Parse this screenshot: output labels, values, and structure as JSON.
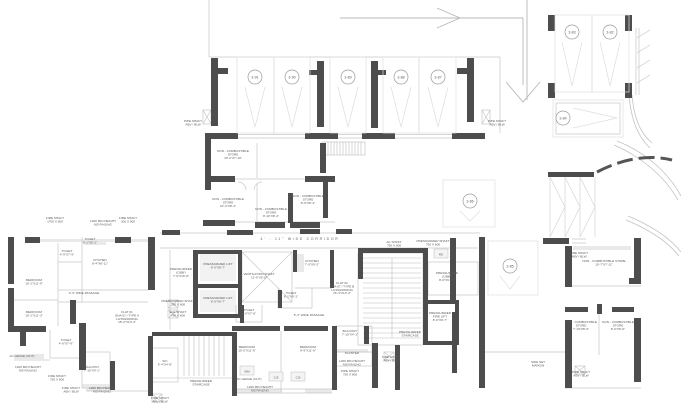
{
  "palette": {
    "wall": "#4d4d4d",
    "line_light": "#c7c7c7",
    "line_faint": "#dedede",
    "fill_light": "#e9e9e9",
    "text": "#5a5a5a",
    "tag_stroke": "#9a9a9a"
  },
  "parking_stalls": [
    {
      "id": "3-91",
      "cx": 255,
      "cy": 77,
      "rect": [
        237,
        57,
        37,
        76
      ],
      "dir": "down"
    },
    {
      "id": "3-90",
      "cx": 292,
      "cy": 77,
      "rect": [
        274,
        57,
        36,
        76
      ],
      "dir": "down"
    },
    {
      "id": "3-89",
      "cx": 348,
      "cy": 77,
      "rect": [
        330,
        57,
        36,
        76
      ],
      "dir": "down"
    },
    {
      "id": "3-88",
      "cx": 401,
      "cy": 77,
      "rect": [
        383,
        57,
        36,
        76
      ],
      "dir": "down"
    },
    {
      "id": "3-87",
      "cx": 438,
      "cy": 77,
      "rect": [
        419,
        57,
        37,
        76
      ],
      "dir": "down"
    },
    {
      "id": "3-83",
      "cx": 572,
      "cy": 32,
      "rect": [
        555,
        15,
        37,
        77
      ],
      "dir": "down"
    },
    {
      "id": "3-82",
      "cx": 610,
      "cy": 32,
      "rect": [
        592,
        15,
        37,
        77
      ],
      "dir": "down"
    },
    {
      "id": "3-84",
      "cx": 563,
      "cy": 118,
      "rect": [
        553,
        100,
        70,
        37
      ],
      "dir": "right"
    },
    {
      "id": "3-86",
      "cx": 470,
      "cy": 201,
      "rect": [
        443,
        180,
        52,
        47
      ],
      "dir": "down"
    },
    {
      "id": "3-85",
      "cx": 510,
      "cy": 266,
      "rect": [
        488,
        241,
        50,
        54
      ],
      "dir": "down"
    }
  ],
  "annotations": [
    {
      "name": "corridor-note",
      "x": 300,
      "y": 240,
      "size": 3.4,
      "spacing": 1.8,
      "lines": [
        "4' - 11\" WIDE CORRIDOR"
      ]
    },
    {
      "name": "pipe-shaft-note",
      "x": 193,
      "y": 122,
      "lines": [
        "PIPE SHAFT",
        "ABV / BLW"
      ]
    },
    {
      "name": "pipe-shaft-note",
      "x": 497,
      "y": 122,
      "lines": [
        "PIPE SHAFT",
        "ABV / BLW"
      ]
    },
    {
      "name": "store-label",
      "x": 233,
      "y": 152,
      "lines": [
        "NON - COMBUSTIBLE",
        "STORE",
        "10'-2\"X7'-10\""
      ]
    },
    {
      "name": "store-label",
      "x": 228,
      "y": 200,
      "lines": [
        "NON - COMBUSTIBLE",
        "STORE",
        "10'-3\"X8'-4\""
      ]
    },
    {
      "name": "store-label",
      "x": 271,
      "y": 210,
      "lines": [
        "NON - COMBUSTIBLE",
        "STORE",
        "8'-10\"X8'-4\""
      ]
    },
    {
      "name": "store-label",
      "x": 308,
      "y": 197,
      "lines": [
        "NON - COMBUSTIBLE",
        "STORE",
        "8'-9\"X8'-4\""
      ]
    },
    {
      "name": "shaft-note",
      "x": 55,
      "y": 219,
      "lines": [
        "FIRE SHAFT",
        "1700 X 600"
      ]
    },
    {
      "name": "railing-note",
      "x": 103,
      "y": 222,
      "lines": [
        "1200 MIN HEIGHT",
        "MS RAILING"
      ]
    },
    {
      "name": "shaft-note",
      "x": 128,
      "y": 219,
      "lines": [
        "FIRE SHAFT",
        "200 X 600"
      ]
    },
    {
      "name": "room-label",
      "x": 34,
      "y": 281,
      "lines": [
        "BEDROOM",
        "10'-2\"X11'-9\""
      ]
    },
    {
      "name": "room-label",
      "x": 34,
      "y": 313,
      "lines": [
        "BEDROOM",
        "10'-2\"X11'-3\""
      ]
    },
    {
      "name": "room-label",
      "x": 67,
      "y": 252,
      "lines": [
        "TOILET",
        "4'-9\"X7'-9\""
      ]
    },
    {
      "name": "room-label",
      "x": 90,
      "y": 240,
      "lines": [
        "TOILET",
        "8'-1\"X5'-1\""
      ]
    },
    {
      "name": "room-label",
      "x": 100,
      "y": 261,
      "lines": [
        "KITCHEN",
        "8'-4\"X8'-11\""
      ]
    },
    {
      "name": "passage-note",
      "x": 84,
      "y": 294,
      "lines": [
        "3'-3\" WIDE PASSAGE"
      ]
    },
    {
      "name": "flat-title",
      "x": 127,
      "y": 313,
      "lines": [
        "FLAT 01",
        "GHA 07 / TYPE A",
        "LIVING/DINING",
        "18'-0\"X13'-3\""
      ]
    },
    {
      "name": "room-label",
      "x": 66,
      "y": 341,
      "lines": [
        "TOILET",
        "4'-9\"X7'-9\""
      ]
    },
    {
      "name": "ledge-note",
      "x": 22,
      "y": 357,
      "lines": [
        "AC LEDGE (OUT)"
      ]
    },
    {
      "name": "railing-note",
      "x": 28,
      "y": 368,
      "lines": [
        "1200 MIN HEIGHT",
        "MS RAILING"
      ]
    },
    {
      "name": "room-label",
      "x": 92,
      "y": 368,
      "lines": [
        "BALCONY",
        "7'-10\"X4'-1\""
      ]
    },
    {
      "name": "shaft-note",
      "x": 57,
      "y": 377,
      "lines": [
        "FIRE SHAFT",
        "750 X 600"
      ]
    },
    {
      "name": "shaft-note",
      "x": 71,
      "y": 389,
      "lines": [
        "FIRE SHAFT",
        "ABV / BLW"
      ]
    },
    {
      "name": "railing-note",
      "x": 102,
      "y": 389,
      "lines": [
        "1200 MIN HEIGHT",
        "MS RAILING"
      ]
    },
    {
      "name": "room-label",
      "x": 181,
      "y": 270,
      "lines": [
        "PRESSURIZED",
        "LOBBY",
        "7'-0\"X19'-8\""
      ]
    },
    {
      "name": "room-label",
      "x": 218,
      "y": 265,
      "lines": [
        "PRESSURIZED LIFT",
        "8'-0\"X8'-7\""
      ]
    },
    {
      "name": "room-label",
      "x": 218,
      "y": 299,
      "lines": [
        "PRESSURIZED LIFT",
        "8'-0\"X8'-7\""
      ]
    },
    {
      "name": "shaft-note",
      "x": 178,
      "y": 302,
      "lines": [
        "PRESSURIZED SHAFT",
        "750 X 600"
      ]
    },
    {
      "name": "shaft-note",
      "x": 178,
      "y": 313,
      "lines": [
        "ELE SHAFT",
        "750 X 600"
      ]
    },
    {
      "name": "room-label",
      "x": 259,
      "y": 275,
      "lines": [
        "VENTILATION SHAFT",
        "12'-0\"X5'-0\""
      ]
    },
    {
      "name": "room-label",
      "x": 312,
      "y": 262,
      "lines": [
        "KITCHEN",
        "7'-9\"X9'-2\""
      ]
    },
    {
      "name": "room-label",
      "x": 291,
      "y": 294,
      "lines": [
        "TOILET",
        "8'-1\"X5'-1\""
      ]
    },
    {
      "name": "room-label",
      "x": 249,
      "y": 311,
      "lines": [
        "TOILET",
        "4'-9\"X7'-6\""
      ]
    },
    {
      "name": "passage-note",
      "x": 309,
      "y": 316,
      "lines": [
        "5'-3\" WIDE PASSAGE"
      ]
    },
    {
      "name": "flat-title",
      "x": 342,
      "y": 284,
      "lines": [
        "FLAT 02",
        "GHA 07 / TYPE B",
        "LIVING/DINING",
        "16'-4\"X13'-3\""
      ]
    },
    {
      "name": "shaft-note",
      "x": 394,
      "y": 243,
      "lines": [
        "AC SHAFT",
        "750 X 600"
      ]
    },
    {
      "name": "shaft-note",
      "x": 433,
      "y": 242,
      "lines": [
        "PRESSURIZED SHAFT",
        "750 X 600"
      ]
    },
    {
      "name": "room-label",
      "x": 447,
      "y": 274,
      "lines": [
        "PRESSURIZED",
        "LOBBY",
        "8'-0\"X9'-10\""
      ]
    },
    {
      "name": "room-label",
      "x": 440,
      "y": 314,
      "lines": [
        "PRESSURIZED",
        "FIRE LIFT",
        "8'-0\"X8'-7\""
      ]
    },
    {
      "name": "room-label",
      "x": 410,
      "y": 333,
      "lines": [
        "PRESSURIZED",
        "STAIRCASE"
      ]
    },
    {
      "name": "room-label",
      "x": 165,
      "y": 362,
      "lines": [
        "WC",
        "5'-4\"X4'-9\""
      ]
    },
    {
      "name": "room-label",
      "x": 201,
      "y": 382,
      "lines": [
        "PRESSURIZED",
        "STAIRCASE"
      ]
    },
    {
      "name": "shaft-note",
      "x": 160,
      "y": 399,
      "lines": [
        "FIRE SHAFT",
        "ABV / BLW"
      ]
    },
    {
      "name": "room-label",
      "x": 247,
      "y": 348,
      "lines": [
        "BEDROOM",
        "10'-0\"X11'-6\""
      ]
    },
    {
      "name": "room-label",
      "x": 308,
      "y": 348,
      "lines": [
        "BEDROOM",
        "9'-9\"X11'-6\""
      ]
    },
    {
      "name": "room-label",
      "x": 350,
      "y": 332,
      "lines": [
        "BALCONY",
        "7'-10\"X4'-1\""
      ]
    },
    {
      "name": "room-label",
      "x": 352,
      "y": 354,
      "lines": [
        "PLANTER"
      ]
    },
    {
      "name": "ledge-note",
      "x": 249,
      "y": 380,
      "lines": [
        "AC LEDGE (OUT)"
      ]
    },
    {
      "name": "railing-note",
      "x": 260,
      "y": 388,
      "lines": [
        "1200 MIN HEIGHT",
        "MS RAILING"
      ]
    },
    {
      "name": "railing-note",
      "x": 352,
      "y": 362,
      "lines": [
        "1200 MIN HEIGHT",
        "MS RAILING"
      ]
    },
    {
      "name": "shaft-note",
      "x": 350,
      "y": 372,
      "lines": [
        "PIPE SHAFT",
        "750 X 600"
      ]
    },
    {
      "name": "shaft-note",
      "x": 391,
      "y": 358,
      "lines": [
        "FIRE SHAFT",
        "ABV / BLW"
      ]
    },
    {
      "name": "margin-note",
      "x": 538,
      "y": 363,
      "lines": [
        "SIDE SET",
        "MARGIN"
      ]
    },
    {
      "name": "shaft-note",
      "x": 579,
      "y": 254,
      "lines": [
        "FIRE SHAFT",
        "ABV / BLW"
      ]
    },
    {
      "name": "store-label",
      "x": 604,
      "y": 262,
      "lines": [
        "NON - COMBUSTIBLE STORE",
        "10'-7\"X7'-11\""
      ]
    },
    {
      "name": "store-label",
      "x": 581,
      "y": 323,
      "lines": [
        "NON - COMBUSTIBLE",
        "STORE",
        "7'-10\"X8'-0\""
      ]
    },
    {
      "name": "store-label",
      "x": 618,
      "y": 323,
      "lines": [
        "NON - COMBUSTIBLE",
        "STORE",
        "8'-0\"X8'-0\""
      ]
    },
    {
      "name": "shaft-note",
      "x": 581,
      "y": 373,
      "lines": [
        "PIPE SHAFT",
        "ABV / BLW"
      ]
    }
  ],
  "codes": [
    {
      "text": "C.B",
      "x": 276,
      "y": 377
    },
    {
      "text": "C.B",
      "x": 298,
      "y": 377
    },
    {
      "text": "WM",
      "x": 247,
      "y": 371
    },
    {
      "text": "RD",
      "x": 441,
      "y": 254
    }
  ]
}
